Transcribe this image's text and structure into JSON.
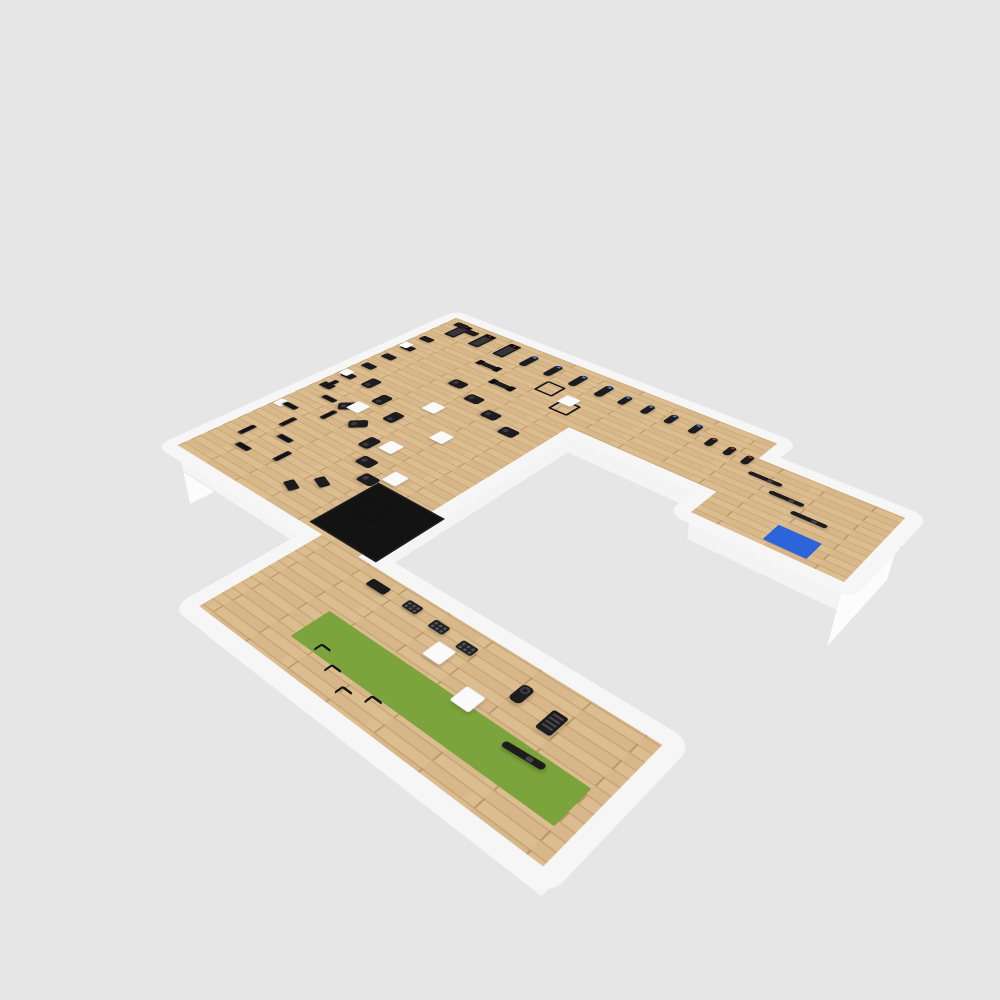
{
  "scene": {
    "title": "Ole Fit gym - 3D isometric floor plan render",
    "shape": "C-shaped floor plate, light wood flooring, white walls, viewed in isometric 3D on gray background"
  },
  "brand": {
    "logo_text_1": "Ole",
    "logo_text_2": "Fit",
    "logo_location": "painted on white end wall of right cardio wing",
    "underline": "thin red horizontal line across logo wall",
    "dot_over_i": "red"
  },
  "colors": {
    "background": "#e6e6e6",
    "wall": "#fcfcfc",
    "slab": "#f6f6f6",
    "wood-base": "#dcbd90",
    "wood-shade": "#d2b082",
    "wood-line": "#c3a06e",
    "wood-joint": "#b08c5a",
    "turf-green": "#7ca43c",
    "mat-blue": "#2c64d9",
    "equipment-dark": "#1c1c1e",
    "platform-black": "#131313",
    "screen-blue": "#2f7fe8",
    "accent-red": "#e02a33"
  },
  "medball_colors": [
    "#e23b2e",
    "#f6d500",
    "#1e4fd8",
    "#f0f0f0",
    "#f07818",
    "#3a7d2c"
  ],
  "zones": [
    {
      "name": "cardio-row",
      "description": "top wing along back wall: 3 treadmills, 4 ellipticals, 4 upright bikes, 3 spin bikes"
    },
    {
      "name": "logo-end-room",
      "description": "far right room: Ole Fit logo wall, 3 rowing machines, blue stretching mat"
    },
    {
      "name": "strength-area",
      "description": "large left wing: selectorized machines, functional trainers, racks, plate-loaded machines, benches"
    },
    {
      "name": "platform-area",
      "description": "black lifting platform with power rig and rack"
    },
    {
      "name": "functional-wing",
      "description": "bottom wing: medicine-ball rack, dumbbell racks, green turf strip, hurdles, air bike, stair climber, rower"
    }
  ],
  "summary_counts": {
    "treadmills": 3,
    "ellipticals": 4,
    "upright_bikes": 4,
    "spin_bikes": 3,
    "rowers": 4,
    "strength_machines": 8,
    "functional_trainers": 2,
    "racks_and_rigs": 4,
    "plate_loaded_machines": 12,
    "benches": 9,
    "dumbbell_racks": 3,
    "medicine_ball_racks": 1,
    "white_column_blocks": 8,
    "wall_pillars": 3,
    "hurdles": 4,
    "air_bikes": 1,
    "stair_climbers": 1,
    "blue_mats": 1,
    "turf_strips": 1,
    "platforms": 1
  },
  "equipment": [
    {
      "t": "treadmill",
      "x": 30,
      "y": 12
    },
    {
      "t": "treadmill",
      "x": 88,
      "y": 12
    },
    {
      "t": "treadmill",
      "x": 146,
      "y": 12
    },
    {
      "t": "elliptical",
      "x": 205,
      "y": 22
    },
    {
      "t": "elliptical",
      "x": 258,
      "y": 22
    },
    {
      "t": "elliptical",
      "x": 311,
      "y": 22
    },
    {
      "t": "elliptical",
      "x": 364,
      "y": 22
    },
    {
      "t": "upright_bike",
      "x": 408,
      "y": 30
    },
    {
      "t": "upright_bike",
      "x": 452,
      "y": 30
    },
    {
      "t": "upright_bike",
      "x": 496,
      "y": 30
    },
    {
      "t": "upright_bike",
      "x": 540,
      "y": 30
    },
    {
      "t": "spin_bike",
      "x": 578,
      "y": 48
    },
    {
      "t": "spin_bike",
      "x": 612,
      "y": 52
    },
    {
      "t": "spin_bike",
      "x": 644,
      "y": 56
    },
    {
      "t": "rower",
      "x": 668,
      "y": 92
    },
    {
      "t": "rower",
      "x": 714,
      "y": 116
    },
    {
      "t": "rower",
      "x": 760,
      "y": 140
    },
    {
      "t": "mat",
      "x": 762,
      "y": 182
    },
    {
      "t": "machine",
      "x": 16,
      "y": 10
    },
    {
      "t": "machine",
      "x": 52,
      "y": 20
    },
    {
      "t": "machine",
      "x": 10,
      "y": 92
    },
    {
      "t": "machine",
      "x": 10,
      "y": 138
    },
    {
      "t": "machine",
      "x": 10,
      "y": 184
    },
    {
      "t": "machine",
      "x": 10,
      "y": 230
    },
    {
      "t": "machine",
      "x": 10,
      "y": 276
    },
    {
      "t": "machine",
      "x": 10,
      "y": 322
    },
    {
      "t": "pillar",
      "x": 2,
      "y": 130
    },
    {
      "t": "pillar",
      "x": 2,
      "y": 268
    },
    {
      "t": "pillar",
      "x": 2,
      "y": 406
    },
    {
      "t": "functional_trainer",
      "x": 150,
      "y": 96
    },
    {
      "t": "functional_trainer",
      "x": 212,
      "y": 132
    },
    {
      "t": "rack",
      "x": 282,
      "y": 76
    },
    {
      "t": "rack",
      "x": 338,
      "y": 108
    },
    {
      "t": "plate_machine",
      "x": 168,
      "y": 168,
      "r": 90
    },
    {
      "t": "plate_machine",
      "x": 222,
      "y": 188,
      "r": 90
    },
    {
      "t": "plate_machine",
      "x": 276,
      "y": 208,
      "r": 90
    },
    {
      "t": "plate_machine",
      "x": 330,
      "y": 228,
      "r": 90
    },
    {
      "t": "plate_machine",
      "x": 60,
      "y": 262
    },
    {
      "t": "plate_machine",
      "x": 114,
      "y": 288
    },
    {
      "t": "plate_machine",
      "x": 168,
      "y": 314
    },
    {
      "t": "plate_machine",
      "x": 88,
      "y": 338,
      "r": 45
    },
    {
      "t": "plate_machine",
      "x": 142,
      "y": 364,
      "r": 45
    },
    {
      "t": "plate_machine",
      "x": 196,
      "y": 390
    },
    {
      "t": "plate_machine",
      "x": 232,
      "y": 428,
      "r": 90
    },
    {
      "t": "plate_machine",
      "x": 268,
      "y": 458,
      "r": 90
    },
    {
      "t": "bench",
      "x": 18,
      "y": 308
    },
    {
      "t": "bench",
      "x": 54,
      "y": 342,
      "r": 90
    },
    {
      "t": "bench",
      "x": 92,
      "y": 376
    },
    {
      "t": "bench",
      "x": 26,
      "y": 398,
      "r": 90
    },
    {
      "t": "bench",
      "x": 62,
      "y": 432
    },
    {
      "t": "bench",
      "x": 98,
      "y": 466,
      "r": 90
    },
    {
      "t": "bench",
      "x": 34,
      "y": 488
    },
    {
      "t": "bench",
      "x": 70,
      "y": 522,
      "r": 90
    },
    {
      "t": "bench",
      "x": 134,
      "y": 500
    },
    {
      "t": "machine",
      "x": 222,
      "y": 512,
      "r": 20
    },
    {
      "t": "machine",
      "x": 196,
      "y": 546,
      "r": 20
    },
    {
      "t": "cube",
      "x": 335,
      "y": 92
    },
    {
      "t": "cube",
      "x": 190,
      "y": 252
    },
    {
      "t": "cube",
      "x": 100,
      "y": 330
    },
    {
      "t": "cube",
      "x": 262,
      "y": 308
    },
    {
      "t": "cube",
      "x": 226,
      "y": 378
    },
    {
      "t": "cube",
      "x": 292,
      "y": 432
    },
    {
      "t": "platform",
      "x": 295,
      "y": 468
    },
    {
      "t": "rig",
      "x": 312,
      "y": 498
    },
    {
      "t": "rack",
      "x": 366,
      "y": 540
    },
    {
      "t": "medball_rack",
      "x": 446,
      "y": 616
    },
    {
      "t": "dumbbell_rack",
      "x": 508,
      "y": 614
    },
    {
      "t": "dumbbell_rack",
      "x": 556,
      "y": 618
    },
    {
      "t": "dumbbell_rack",
      "x": 604,
      "y": 622
    },
    {
      "t": "turf",
      "x": 452,
      "y": 692
    },
    {
      "t": "hurdle",
      "x": 488,
      "y": 734
    },
    {
      "t": "hurdle",
      "x": 522,
      "y": 748
    },
    {
      "t": "hurdle",
      "x": 556,
      "y": 762
    },
    {
      "t": "hurdle",
      "x": 590,
      "y": 750
    },
    {
      "t": "cube",
      "x": 584,
      "y": 642
    },
    {
      "t": "cube",
      "x": 656,
      "y": 672
    },
    {
      "t": "air_bike",
      "x": 700,
      "y": 628
    },
    {
      "t": "stair_climber",
      "x": 748,
      "y": 636
    },
    {
      "t": "rower",
      "x": 738,
      "y": 700,
      "r": -4
    }
  ]
}
